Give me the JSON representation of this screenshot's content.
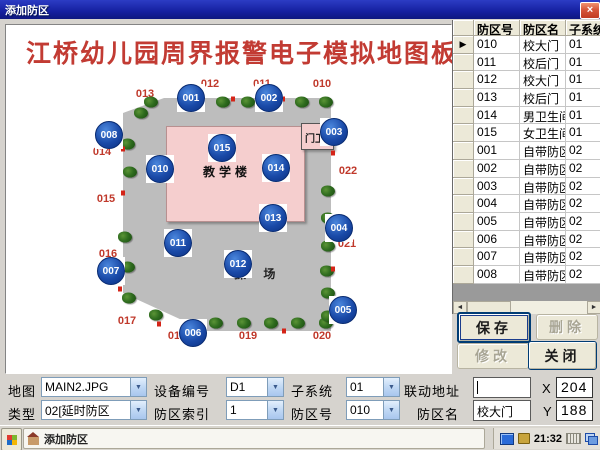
{
  "icons": {
    "close": "×",
    "combo_arrow": "▼",
    "row_pointer": "▶",
    "scroll_left": "◄",
    "scroll_right": "►"
  },
  "titlebar": {
    "title": "添加防区"
  },
  "map_panel": {
    "title": "江桥幼儿园周界报警电子模拟地图板",
    "building_label": "教学楼",
    "gatehouse_label": "门卫",
    "playground_label": "操 场",
    "sensors": [
      {
        "id": "001",
        "x": 185,
        "y": 73
      },
      {
        "id": "002",
        "x": 263,
        "y": 73
      },
      {
        "id": "003",
        "x": 328,
        "y": 107
      },
      {
        "id": "004",
        "x": 333,
        "y": 203
      },
      {
        "id": "005",
        "x": 337,
        "y": 285
      },
      {
        "id": "006",
        "x": 187,
        "y": 308
      },
      {
        "id": "007",
        "x": 105,
        "y": 246
      },
      {
        "id": "008",
        "x": 103,
        "y": 110
      },
      {
        "id": "010",
        "x": 154,
        "y": 144
      },
      {
        "id": "011",
        "x": 172,
        "y": 218
      },
      {
        "id": "012",
        "x": 232,
        "y": 239
      },
      {
        "id": "013",
        "x": 267,
        "y": 193
      },
      {
        "id": "014",
        "x": 270,
        "y": 143
      },
      {
        "id": "015",
        "x": 216,
        "y": 123
      }
    ],
    "perimeter_labels": [
      {
        "text": "013",
        "x": 139,
        "y": 69
      },
      {
        "text": "012",
        "x": 204,
        "y": 59
      },
      {
        "text": "011",
        "x": 256,
        "y": 59
      },
      {
        "text": "010",
        "x": 316,
        "y": 59
      },
      {
        "text": "022",
        "x": 342,
        "y": 146
      },
      {
        "text": "021",
        "x": 341,
        "y": 219
      },
      {
        "text": "020",
        "x": 316,
        "y": 311
      },
      {
        "text": "019",
        "x": 242,
        "y": 311
      },
      {
        "text": "018",
        "x": 171,
        "y": 311
      },
      {
        "text": "017",
        "x": 121,
        "y": 296
      },
      {
        "text": "016",
        "x": 102,
        "y": 229
      },
      {
        "text": "015",
        "x": 100,
        "y": 174
      },
      {
        "text": "014",
        "x": 96,
        "y": 127
      }
    ],
    "trees": [
      [
        145,
        77
      ],
      [
        217,
        77
      ],
      [
        242,
        77
      ],
      [
        296,
        77
      ],
      [
        320,
        77
      ],
      [
        135,
        88
      ],
      [
        122,
        119
      ],
      [
        124,
        147
      ],
      [
        119,
        212
      ],
      [
        122,
        242
      ],
      [
        123,
        273
      ],
      [
        150,
        290
      ],
      [
        210,
        298
      ],
      [
        238,
        298
      ],
      [
        265,
        298
      ],
      [
        292,
        298
      ],
      [
        320,
        298
      ],
      [
        322,
        166
      ],
      [
        322,
        193
      ],
      [
        322,
        221
      ],
      [
        321,
        246
      ],
      [
        322,
        268
      ],
      [
        322,
        291
      ]
    ],
    "tick_marks": [
      [
        227,
        74
      ],
      [
        277,
        74
      ],
      [
        117,
        124
      ],
      [
        117,
        168
      ],
      [
        117,
        238
      ],
      [
        114,
        264
      ],
      [
        327,
        96
      ],
      [
        327,
        128
      ],
      [
        327,
        214
      ],
      [
        327,
        244
      ],
      [
        181,
        306
      ],
      [
        278,
        306
      ],
      [
        153,
        299
      ]
    ]
  },
  "zone_table": {
    "headers": [
      "防区号",
      "防区名",
      "子系统"
    ],
    "rows": [
      [
        "010",
        "校大门",
        "01"
      ],
      [
        "011",
        "校后门",
        "01"
      ],
      [
        "012",
        "校大门",
        "01"
      ],
      [
        "013",
        "校后门",
        "01"
      ],
      [
        "014",
        "男卫生间",
        "01"
      ],
      [
        "015",
        "女卫生间",
        "01"
      ],
      [
        "001",
        "自带防区",
        "02"
      ],
      [
        "002",
        "自带防区",
        "02"
      ],
      [
        "003",
        "自带防区",
        "02"
      ],
      [
        "004",
        "自带防区",
        "02"
      ],
      [
        "005",
        "自带防区",
        "02"
      ],
      [
        "006",
        "自带防区",
        "02"
      ],
      [
        "007",
        "自带防区",
        "02"
      ],
      [
        "008",
        "自带防区",
        "02"
      ]
    ],
    "selected_row_index": 0
  },
  "action_buttons": {
    "save": {
      "label": "保存",
      "enabled": true
    },
    "delete": {
      "label": "删除",
      "enabled": false
    },
    "modify": {
      "label": "修改",
      "enabled": false
    },
    "close": {
      "label": "关闭",
      "enabled": true
    }
  },
  "form": {
    "map": {
      "label": "地图",
      "value": "MAIN2.JPG"
    },
    "device": {
      "label": "设备编号",
      "value": "D1"
    },
    "subsystem": {
      "label": "子系统",
      "value": "01"
    },
    "linkage": {
      "label": "联动地址",
      "value": ""
    },
    "x": {
      "label": "X",
      "value": "204"
    },
    "type": {
      "label": "类型",
      "value": "02[延时防区"
    },
    "zone_index": {
      "label": "防区索引",
      "value": "1"
    },
    "zone_no": {
      "label": "防区号",
      "value": "010"
    },
    "zone_name": {
      "label": "防区名",
      "value": "校大门"
    },
    "y": {
      "label": "Y",
      "value": "188"
    }
  },
  "taskbar": {
    "window_button": "添加防区",
    "clock": "21:32"
  }
}
